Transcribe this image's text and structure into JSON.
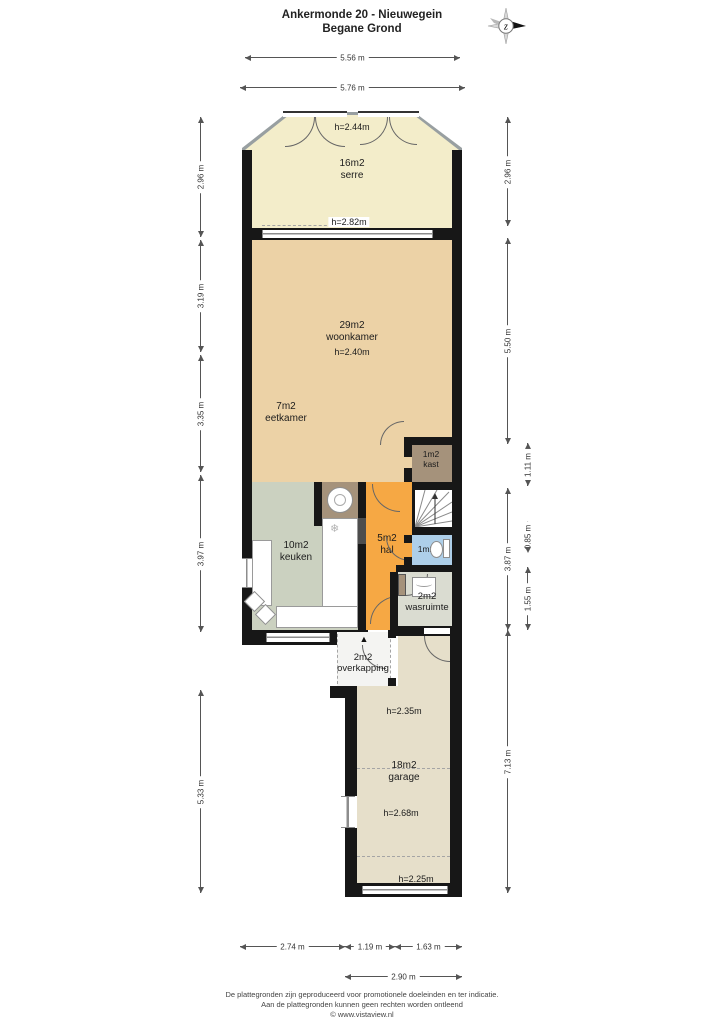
{
  "title": {
    "line1": "Ankermonde 20 - Nieuwegein",
    "line2": "Begane Grond"
  },
  "compass": {
    "label": "z"
  },
  "dimensions": {
    "top": [
      "5.56 m",
      "5.76 m"
    ],
    "left": [
      "2.96 m",
      "3.19 m",
      "3.35 m",
      "3.97 m",
      "5.33 m"
    ],
    "right_outer": [
      "2.96 m",
      "5.50 m",
      "3.87 m",
      "7.13 m"
    ],
    "right_inner": [
      "1.11 m",
      "0.85 m",
      "1.55 m"
    ],
    "bottom": [
      "2.74 m",
      "1.19 m",
      "1.63 m"
    ],
    "bottom_total": "2.90 m"
  },
  "rooms": {
    "serre": {
      "area": "16m2",
      "name": "serre",
      "height_top": "h=2.44m",
      "height_bottom": "h=2.82m"
    },
    "woonkamer": {
      "area": "29m2",
      "name": "woonkamer",
      "height": "h=2.40m"
    },
    "eetkamer": {
      "area": "7m2",
      "name": "eetkamer"
    },
    "kast": {
      "area": "1m2",
      "name": "kast"
    },
    "keuken": {
      "area": "10m2",
      "name": "keuken"
    },
    "hal": {
      "area": "5m2",
      "name": "hal"
    },
    "toilet": {
      "area": "1m2"
    },
    "wasruimte": {
      "area": "2m2",
      "name": "wasruimte"
    },
    "overkapping": {
      "area": "2m2",
      "name": "overkapping"
    },
    "garage": {
      "area": "18m2",
      "name": "garage",
      "height_top": "h=2.35m",
      "height_mid": "h=2.68m",
      "height_bottom": "h=2.25m"
    }
  },
  "icons": {
    "entrance": "▲",
    "snowflake": "❄"
  },
  "footer": {
    "line1": "De plattegronden zijn geproduceerd voor promotionele doeleinden en ter indicatie.",
    "line2": "Aan de plattegronden kunnen geen rechten worden ontleend",
    "line3": "© www.vistaview.nl"
  },
  "colors": {
    "wall": "#171717",
    "serre": "#f3edca",
    "woonkamer": "#ecd2a6",
    "kast": "#a5927b",
    "keuken": "#cbd1c0",
    "hal": "#f6a844",
    "toilet": "#aecfe9",
    "wasruimte": "#dadcd1",
    "overkapping": "#f4f4f2",
    "garage": "#e6dfca",
    "glass": "#989fa1",
    "shaft": "#4d4d4d"
  }
}
